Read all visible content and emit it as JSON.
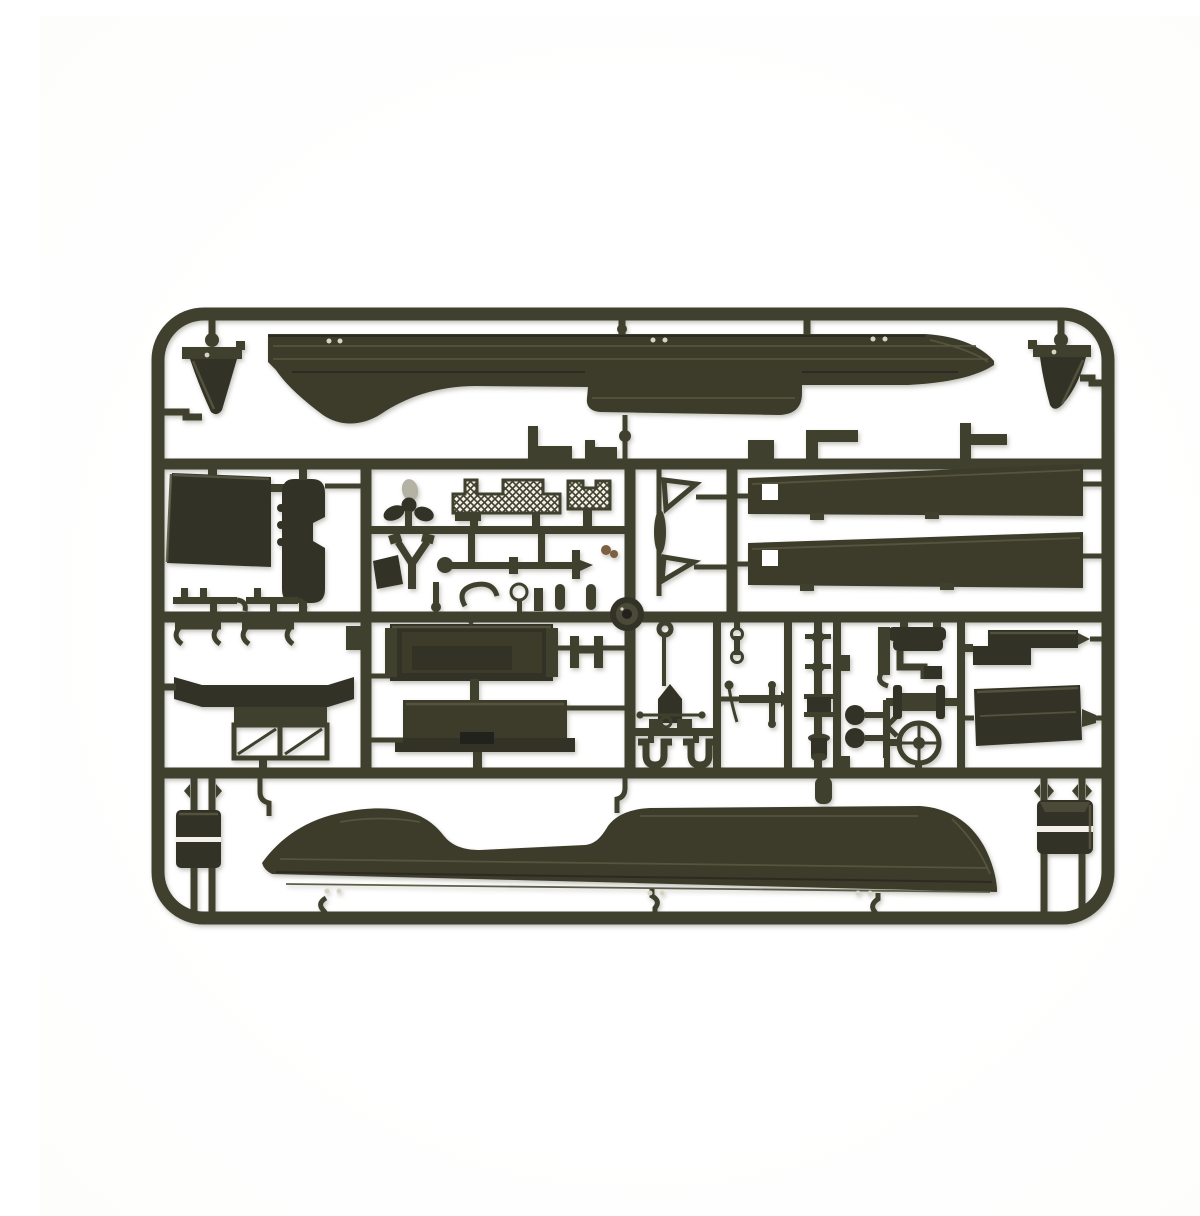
{
  "meta": {
    "description": "Top-down photograph of a dark olive-green injection-molded plastic model kit sprue (parts tree) on a plain white background. The rounded rectangular frame holds two long boat-hull halves at top and bottom, two tapered deck planks, ventilation cowls in the corners, flat panels, a three-blade propeller, two molded mesh grilles, a steering wheel, a winch drum, stowage boxes and dozens of small fittings joined by runners.",
    "object_type": "plastic model kit sprue",
    "background": "plain white"
  },
  "colors": {
    "background": "#ffffff",
    "plastic": "#403f2e",
    "plastic_dark": "#333227",
    "plastic_mid": "#4b4a38",
    "plastic_deep": "#23231c",
    "hull": "#3c3b2c",
    "highlight_line": "#56553f",
    "shadow_line": "#26251d",
    "mesh_bg": "#f1efe6",
    "blade_highlight": "#b4b1a5",
    "brown_part": "#7d5f43",
    "white_slit": "#f3f1ea",
    "ejector_dot": "#d8d4c4"
  },
  "parts": [
    {
      "id": "sprue-frame",
      "label": "rounded rectangular sprue frame with runners"
    },
    {
      "id": "hull-upper",
      "label": "boat hull half (upper, bow to the right)"
    },
    {
      "id": "hull-lower",
      "label": "boat hull half (lower, bow to the right)"
    },
    {
      "id": "cowl-left",
      "label": "ventilation cowl (top-left corner)"
    },
    {
      "id": "cowl-right",
      "label": "ventilation cowl (top-right corner)"
    },
    {
      "id": "deck-plank-1",
      "label": "long tapered deck plank (upper)"
    },
    {
      "id": "deck-plank-2",
      "label": "long tapered deck plank (lower)"
    },
    {
      "id": "door-panel",
      "label": "large flat door panel"
    },
    {
      "id": "float-pod",
      "label": "elongated pod with side notch"
    },
    {
      "id": "propeller",
      "label": "three-blade propeller"
    },
    {
      "id": "mesh-grille-1",
      "label": "molded mesh grille (large)"
    },
    {
      "id": "mesh-grille-2",
      "label": "molded mesh grille (small)"
    },
    {
      "id": "flag-frame-1",
      "label": "hollow triangular frame (upper)"
    },
    {
      "id": "flag-frame-2",
      "label": "hollow triangular frame (lower)"
    },
    {
      "id": "tie-rod",
      "label": "tie rod / axle with end fittings"
    },
    {
      "id": "fork",
      "label": "Y-shaped fork"
    },
    {
      "id": "pulley-disc",
      "label": "round pulley disc with hub"
    },
    {
      "id": "windshield",
      "label": "two-pane windshield frame"
    },
    {
      "id": "slat-panel-1",
      "label": "recessed rectangular panel (upper)"
    },
    {
      "id": "slat-panel-2",
      "label": "flanged rectangular panel (lower)"
    },
    {
      "id": "mast",
      "label": "mast with ring, vane and crossbar"
    },
    {
      "id": "shackles",
      "label": "pair of U-shackles"
    },
    {
      "id": "linkages",
      "label": "small linkage rods and beads"
    },
    {
      "id": "engine-fittings",
      "label": "engine fitting cluster"
    },
    {
      "id": "winch-drum",
      "label": "flanged winch drum"
    },
    {
      "id": "steering-wheel",
      "label": "four-spoke steering wheel"
    },
    {
      "id": "hood-top",
      "label": "engine hood piece (upper)"
    },
    {
      "id": "hood-main",
      "label": "engine hood piece (main)"
    },
    {
      "id": "stowage-box-left",
      "label": "stowage box on pin runners (bottom-left)"
    },
    {
      "id": "stowage-box-right",
      "label": "stowage box on pin runners (bottom-right)"
    },
    {
      "id": "small-fittings",
      "label": "assorted small clips, hooks, pins and brackets"
    },
    {
      "id": "ejector-dots",
      "label": "pale ejector-pin marks on hull halves"
    }
  ]
}
